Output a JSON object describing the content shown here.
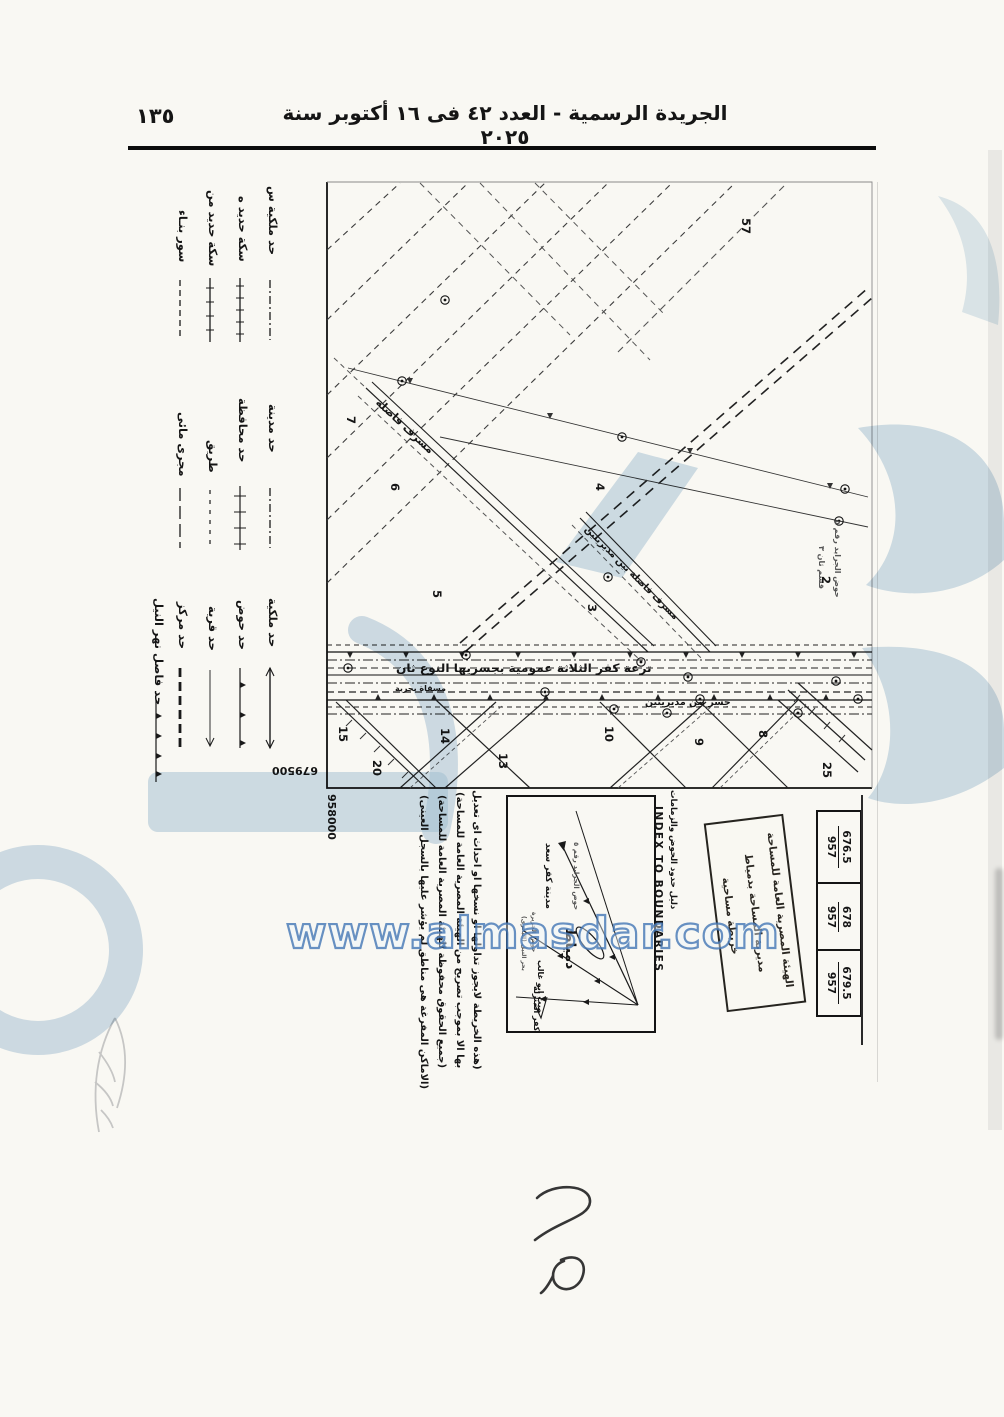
{
  "page": {
    "number": "١٣٥",
    "header": "الجريدة الرسمية - العدد ٤٢ فى ١٦ أكتوبر سنة ٢٠٢٥"
  },
  "watermark": {
    "site": "www.almasdar.com"
  },
  "legend": {
    "group_a": [
      {
        "label": "حد ملكية س",
        "symbol": "dash-dot-line"
      },
      {
        "label": "سكة حديد ه",
        "symbol": "railway-tick-line"
      },
      {
        "label": "سكة حديد من",
        "symbol": "railway-tick-line"
      },
      {
        "label": "سور بنـاء",
        "symbol": "dashed-line"
      }
    ],
    "group_b": [
      {
        "label": "حد مدينة",
        "symbol": "dash-dot-line"
      },
      {
        "label": "حد محافظة",
        "symbol": "cross-tick-line"
      },
      {
        "label": "طريق",
        "symbol": "dashed-line"
      },
      {
        "label": "مجرى مائى",
        "symbol": "long-dash-line"
      }
    ],
    "group_c": [
      {
        "label": "حد ملكية",
        "symbol": "solid-arrow-line"
      },
      {
        "label": "حد حوض",
        "symbol": "triangle-tick-line"
      },
      {
        "label": "حد قرية",
        "symbol": "thin-arrow-line"
      },
      {
        "label": "حد مركز",
        "symbol": "thick-dash-line"
      },
      {
        "label": "حد فاصل نهر النيل",
        "symbol": "triangle-tick-line"
      }
    ]
  },
  "map": {
    "coordinates": {
      "easting": "679500",
      "northing": "958000"
    },
    "labels": {
      "canal": "ترعة كفر الثلاثة عمومية بجسريها النوع ثان",
      "canal_sub": "مسقاة بحرية",
      "bridge": "جسر بين مديريتين",
      "drain_1": "مسرف فاصلة",
      "drain_2": "مسرف فاصلة بين مديريتين",
      "basin_note_1": "حوض الجرايد رقم ٥",
      "basin_note_2": "قسم ثان ٣"
    },
    "plot_numbers": [
      "57",
      "7",
      "6",
      "5",
      "4",
      "3",
      "2",
      "15",
      "20",
      "14",
      "13",
      "10",
      "9",
      "8",
      "25"
    ]
  },
  "index_box": {
    "title_en": "INDEX TO BOUNDARIES",
    "title_ar": "دليل حدود الحوض والزمامات",
    "places": {
      "basin": "حوض الجرايد رقم ٥",
      "city": "مدينة كفر سعد",
      "damietta": "دمياط",
      "mit_abu_ghalib": "ميت ابو غالب",
      "gezira": "حوض الجزيرة",
      "nile": "بحر النيل (البحرى)",
      "kafr": "كفر المنزلة"
    }
  },
  "notes": {
    "line_1": "(هذه الخريطة لايجوز تداولها او نسخها او احداث اى تعديل",
    "line_2": "بها الا بموجب تصريح من الهيئة المصرية العامة للمساحة)",
    "line_3": "(جميع الحقوق محفوظة للهيئة المصرية العامة للمساحة)",
    "line_4": "(الاماكن المفرغة هى مناطق لم يؤشر عليها بالسجل العينى)"
  },
  "stamp": {
    "line_1": "الهيئة المصرية العامة للمساحة",
    "line_2": "مديرية المساحة بدمياط",
    "line_3": "خريطة مساحية"
  },
  "sheet_refs": [
    {
      "left": "957",
      "right": "676.5"
    },
    {
      "left": "957",
      "right": "678"
    },
    {
      "left": "957",
      "right": "679.5"
    }
  ]
}
